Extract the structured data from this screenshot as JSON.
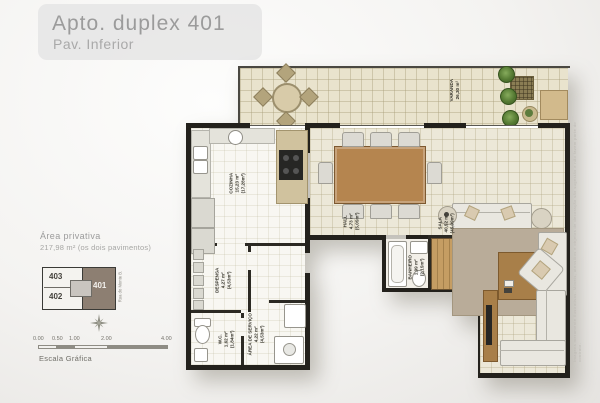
{
  "header": {
    "title": "Apto. duplex 401",
    "subtitle": "Pav. Inferior"
  },
  "info": {
    "area_label": "Área privativa",
    "area_value": "217,98 m² (os dois pavimentos)"
  },
  "rooms": {
    "varanda": {
      "name": "VARANDA",
      "area": "26,30 m²"
    },
    "cozinha": {
      "name": "COZINHA",
      "area": "15,23 m²",
      "area_total": "(17,28m²)"
    },
    "hall": {
      "name": "HALL",
      "area": "4,73 m²",
      "area_total": "(5,05m²)"
    },
    "sala": {
      "name": "SALA",
      "area": "40,52 m²",
      "area_total": "(45,09m²)"
    },
    "banheiro": {
      "name": "BANHEIRO",
      "area": "1,99 m²",
      "area_total": "(2,15m²)"
    },
    "despensa": {
      "name": "DESPENSA",
      "area": "4,27 m²",
      "area_total": "(4,53m²)"
    },
    "wc": {
      "name": "W.C.",
      "area": "1,62 m²",
      "area_total": "(1,84m²)"
    },
    "area_servico": {
      "name": "ÁREA DE SERVIÇO",
      "area": "4,22 m²",
      "area_total": "(4,53m²)"
    }
  },
  "key_plan": {
    "unit_403": "403",
    "unit_402": "402",
    "unit_401": "401",
    "street": "Rua do Monte B."
  },
  "scale": {
    "ticks": [
      "0.00",
      "0.50",
      "1.00",
      "2.00",
      "4.00"
    ],
    "label": "Escala Gráfica"
  },
  "disclaimer": "Imagens meramente ilustrativas. Móveis, utensílios e objetos de decoração são sugestão e não fazem parte do contrato."
}
